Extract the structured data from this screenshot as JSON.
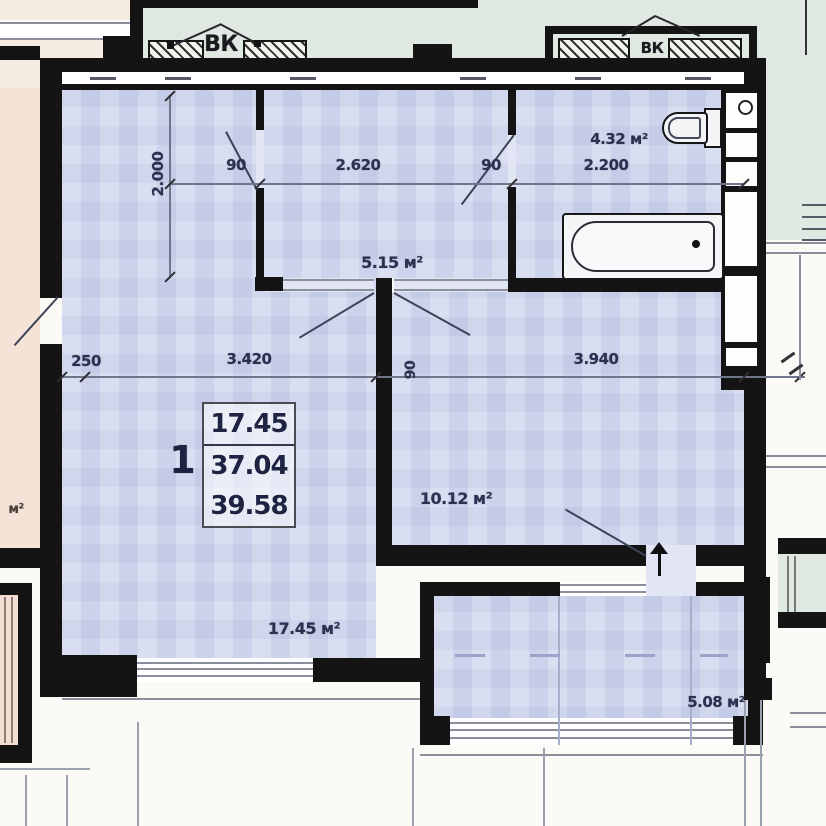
{
  "labels": {
    "shaft1": "ВК",
    "shaft2": "ВК"
  },
  "areas": {
    "hallway": "5.15 м²",
    "bathroom": "4.32 м²",
    "kitchen": "10.12 м²",
    "living": "17.45 м²",
    "balcony": "5.08 м²",
    "neighbor_partial": "м²"
  },
  "dims": {
    "closet_depth": "2.000",
    "living_door": "90",
    "hall_width": "2.620",
    "bath_door": "90",
    "bath_width": "2.200",
    "wall_offset": "250",
    "living_width": "3.420",
    "partition_width": "90",
    "kitchen_width": "3.940"
  },
  "stamp": {
    "rooms_count": "1",
    "living_area": "17.45",
    "apartment_area": "37.04",
    "total_area": "39.58"
  },
  "colors": {
    "floor_blue": "#cdd3ec",
    "exterior_green": "#dfe9e1",
    "neighbor_pink": "#f6e3d7",
    "wall_black": "#141414",
    "dim_text": "#2b3150"
  }
}
